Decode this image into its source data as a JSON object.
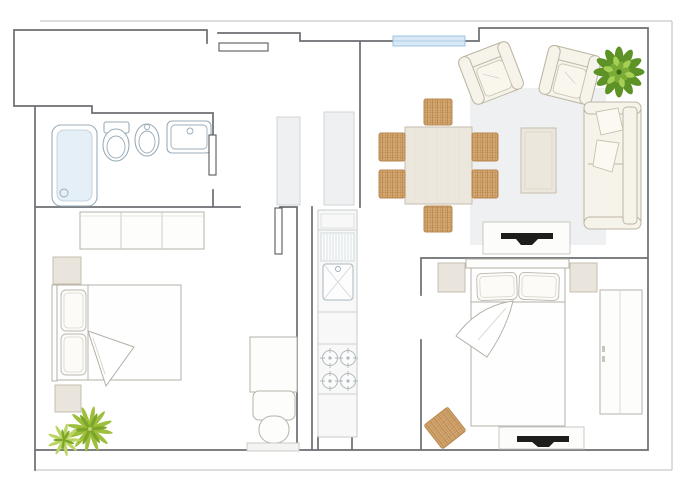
{
  "floorplan": {
    "colors": {
      "background": "#ffffff",
      "wall_line": "#565a5e",
      "outer_line": "#a6aaae",
      "fixture_line": "#9aacb8",
      "furniture_line": "#b6b2a8",
      "cream": "#f6f3ea",
      "cream_line": "#bcb6a3",
      "cabinet_fill": "#eef0f1",
      "wood_light": "#ece7dd",
      "wicker": "#d3a873",
      "wicker_line": "#b98950",
      "rug_gray": "#eff0f1",
      "window_blue": "#d9e8f6",
      "shower_blue": "#e4eff7",
      "tv_black": "#1d1d1b",
      "plant_dark": "#5d9227",
      "plant_mid": "#79ab35",
      "plant_light": "#a5cf55",
      "palm_dark": "#7da52c",
      "palm_mid": "#9ebf3c",
      "palm_light": "#bcd563"
    },
    "rooms": [
      {
        "name": "bathroom",
        "items": [
          "shower",
          "toilet",
          "bidet",
          "sink",
          "bathroom-door"
        ]
      },
      {
        "name": "entry-hall",
        "items": [
          "entry-door",
          "hall-cabinet"
        ]
      },
      {
        "name": "kitchen",
        "items": [
          "tall-unit",
          "counter",
          "kitchen-sink",
          "drainboard",
          "hob-4-burners"
        ]
      },
      {
        "name": "living-dining-room",
        "items": [
          "dining-table",
          "dining-chair-x6",
          "armchair-x2",
          "sofa",
          "coffee-table",
          "rug",
          "tv-stand",
          "plant",
          "window"
        ]
      },
      {
        "name": "bedroom-1",
        "items": [
          "wardrobe",
          "double-bed",
          "nightstand-x2",
          "desk",
          "chair",
          "palm-plant",
          "bedroom-door"
        ]
      },
      {
        "name": "bedroom-2",
        "items": [
          "double-bed",
          "headboard",
          "nightstand-x2",
          "wardrobe",
          "wicker-pouf",
          "tv-stand"
        ]
      }
    ]
  }
}
